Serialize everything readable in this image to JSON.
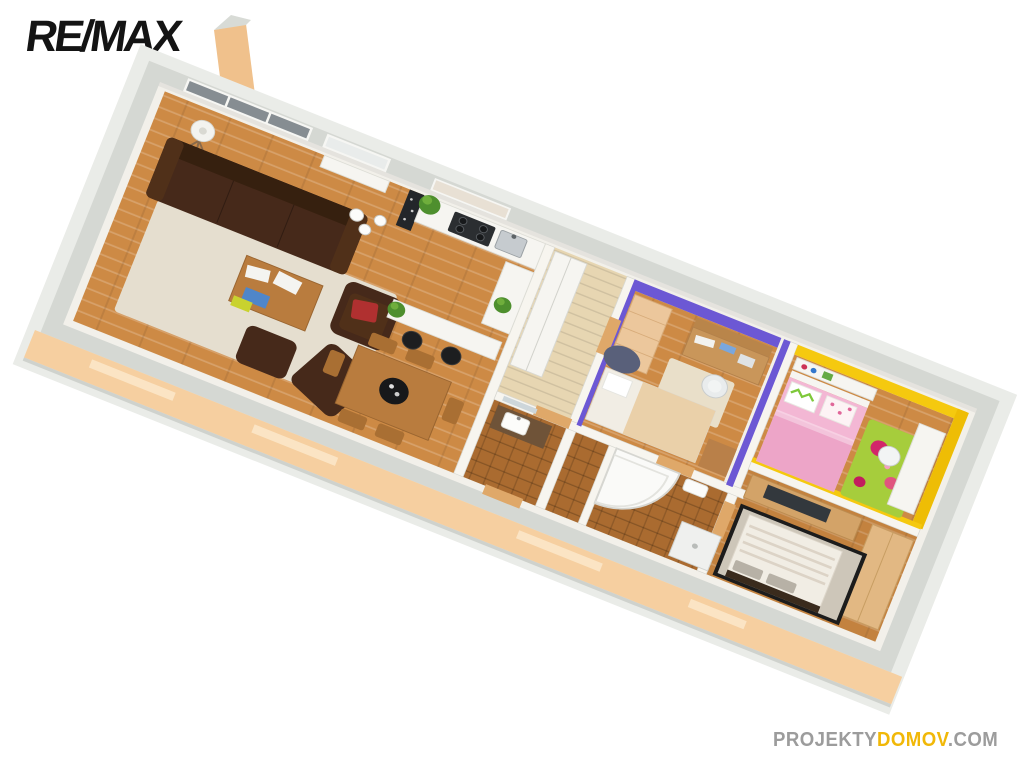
{
  "meta": {
    "kind": "3d-floorplan-render",
    "view": "axonometric-top"
  },
  "logo": {
    "text": "RE/MAX",
    "color": "#141414"
  },
  "watermark": {
    "projekty": "PROJEKTY",
    "domov": "DOMOV",
    "com": ".COM",
    "gray": "#9c9c9c",
    "yellow": "#f1b808"
  },
  "palette": {
    "background": "#ffffff",
    "wall_outer_light": "#eaece8",
    "wall_top_gray": "#d5d8d3",
    "wall_inner_white": "#f2f0ea",
    "partition_white": "#f7f5ef",
    "exterior_peach": "#f6cfa0",
    "window_slit": "#fbe4c4",
    "window_glass_dark": "#868d92",
    "window_glass_light": "#e9eceb",
    "wood_floor": "#cd8a45",
    "tile_corridor": "#e7d6b2",
    "tile_bath": "#aa6b30",
    "rug_living": "#e5decf",
    "rug_study": "#e9dfc9",
    "sofa_brown": "#46291a",
    "sofa_cushion": "#503019",
    "table_wood": "#b97c3e",
    "chair_wood": "#a96f33",
    "purple_wall": "#6c58d4",
    "yellow_wall": "#f5c90f",
    "yellow_wall_deep": "#eebd05",
    "pink_mattress": "#f3b7d4",
    "pink_blanket": "#eda5c8",
    "green_rug": "#a6cd3c",
    "flower_red": "#d2266a",
    "furniture_tan": "#ecc79c",
    "desk_wood": "#c9965a",
    "nightstand_wood": "#b98049",
    "white_furniture": "#f6f5f1",
    "master_rug": "#cdc6b9",
    "rug_border_dark": "#1c1c1c",
    "bed_white": "#f1ede4",
    "blanket_beige": "#ead0a9",
    "headboard_dark": "#3a2b1d",
    "tv_dark": "#33383d",
    "tv_unit_wood": "#d3a368",
    "wardrobe_wood": "#e2b883",
    "stool_black": "#1d1e20",
    "bowl_black": "#17181a",
    "plant_green": "#4e8f2e",
    "plant_green_light": "#6fae3c",
    "beanbag_gray": "#59607a",
    "door_tan": "#dfa869",
    "red_pillow": "#b03030",
    "vanity_wood": "#6f5338",
    "cooktop_dark": "#2b2e31",
    "mosaic_dark": "#23262a",
    "chimney_peach": "#f0c18c"
  },
  "rooms": [
    {
      "id": "living-room"
    },
    {
      "id": "dining-area"
    },
    {
      "id": "kitchen"
    },
    {
      "id": "hallway"
    },
    {
      "id": "study-bedroom"
    },
    {
      "id": "kids-bedroom"
    },
    {
      "id": "bathroom"
    },
    {
      "id": "wc"
    },
    {
      "id": "master-bedroom"
    }
  ]
}
